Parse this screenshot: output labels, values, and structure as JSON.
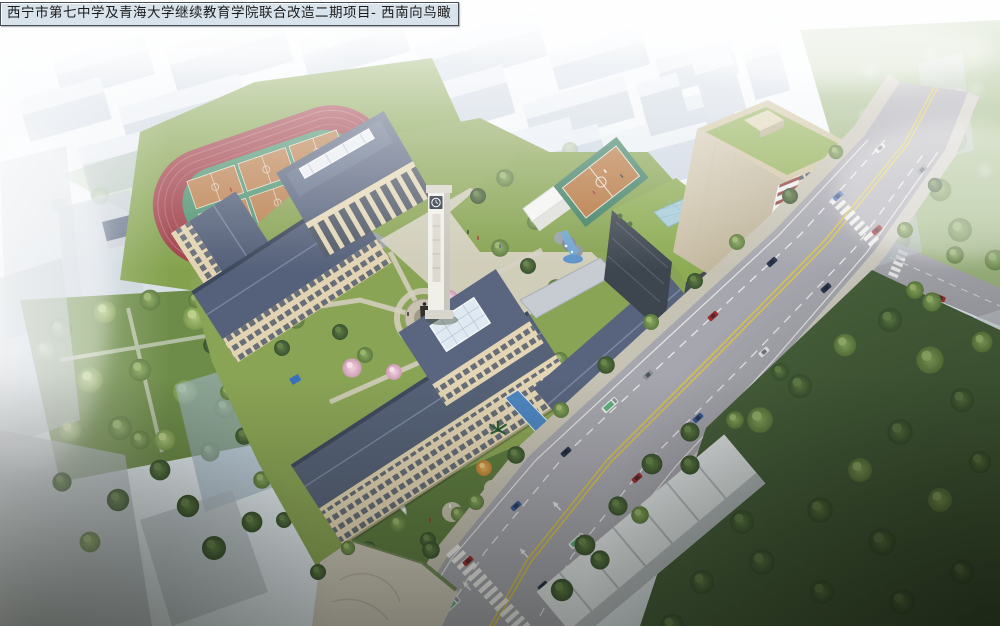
{
  "caption": {
    "text": "西宁市第七中学及青海大学继续教育学院联合改造二期项目- 西南向鸟瞰"
  },
  "colors": {
    "sky": "#eef3f7",
    "haze_white": "#ffffff",
    "track_red": "#a04049",
    "court_orange": "#bb8150",
    "infield_green": "#4f9472",
    "lawn_green": "#8aa455",
    "dark_park_green": "#47603b",
    "roof_slate": "#566278",
    "wall_beige": "#e4d6b4",
    "tower_facade": "#d6ccab",
    "tower_green_roof": "#8fae52",
    "corner_stripe_red": "#8e3d36",
    "road_gray": "#a6a6ae",
    "lane_yellow": "#d8c24f",
    "water_blue": "#4d86c0",
    "glass_pyramid": "#a7ccd9",
    "caption_bg": "#d9e3ec",
    "caption_text": "#1b1b1b"
  }
}
